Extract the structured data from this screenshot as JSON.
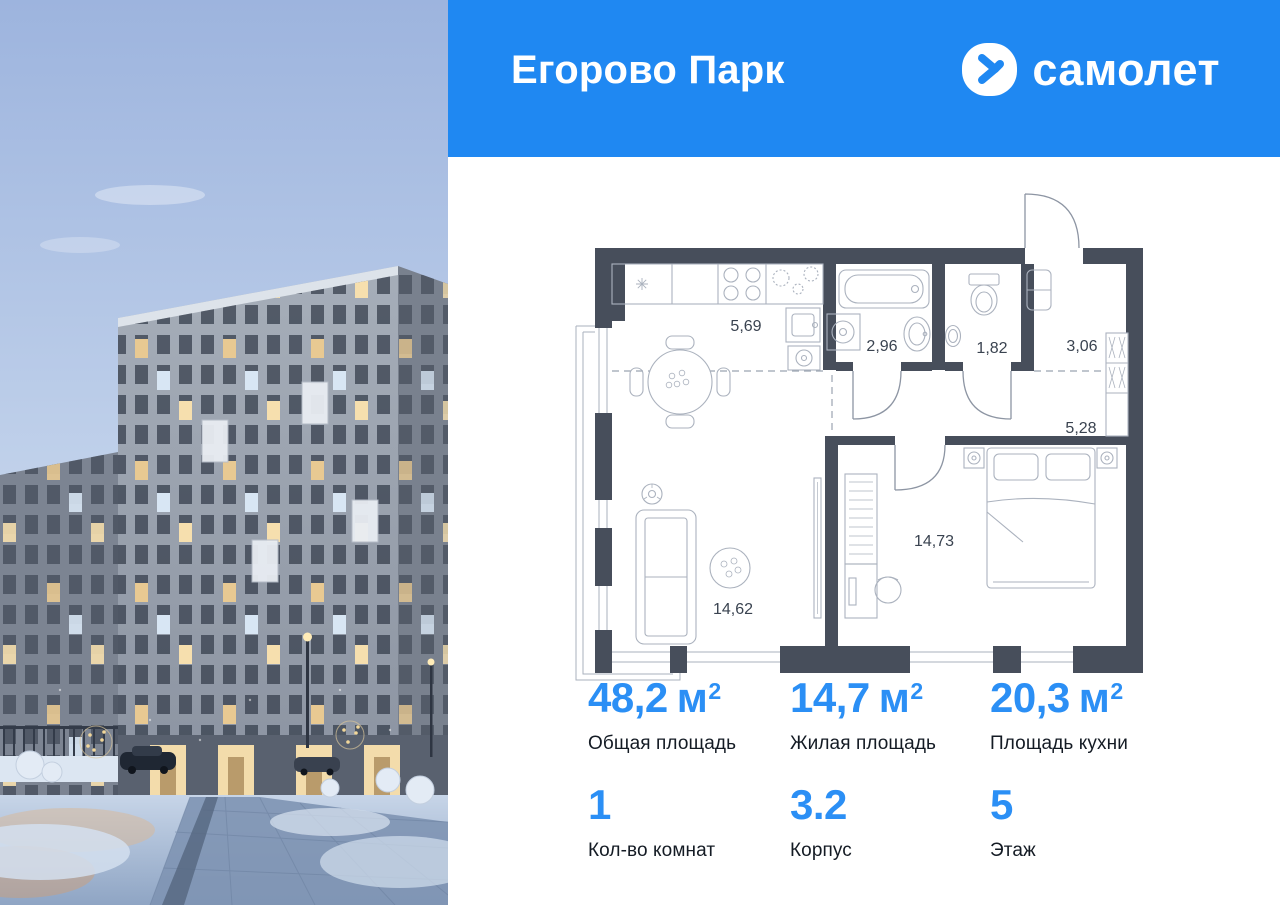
{
  "header": {
    "project_title": "Егорово Парк",
    "brand": "самолет"
  },
  "plan": {
    "rooms": [
      {
        "name": "kitchen-living",
        "area": "5,69"
      },
      {
        "name": "bathroom",
        "area": "2,96"
      },
      {
        "name": "wc",
        "area": "1,82"
      },
      {
        "name": "hallway",
        "area": "3,06"
      },
      {
        "name": "corridor",
        "area": "5,28"
      },
      {
        "name": "bedroom",
        "area": "14,73"
      },
      {
        "name": "living-room",
        "area": "14,62"
      }
    ]
  },
  "stats": {
    "area": [
      {
        "value": "48,2",
        "unit": "м",
        "power": "2",
        "label": "Общая площадь"
      },
      {
        "value": "14,7",
        "unit": "м",
        "power": "2",
        "label": "Жилая площадь"
      },
      {
        "value": "20,3",
        "unit": "м",
        "power": "2",
        "label": "Площадь кухни"
      }
    ],
    "info": [
      {
        "value": "1",
        "label": "Кол-во комнат"
      },
      {
        "value": "3.2",
        "label": "Корпус"
      },
      {
        "value": "5",
        "label": "Этаж"
      }
    ]
  },
  "colors": {
    "header_bg": "#1F88F2",
    "accent_number": "#2B8FF5",
    "plan_wall": "#474E5B"
  }
}
